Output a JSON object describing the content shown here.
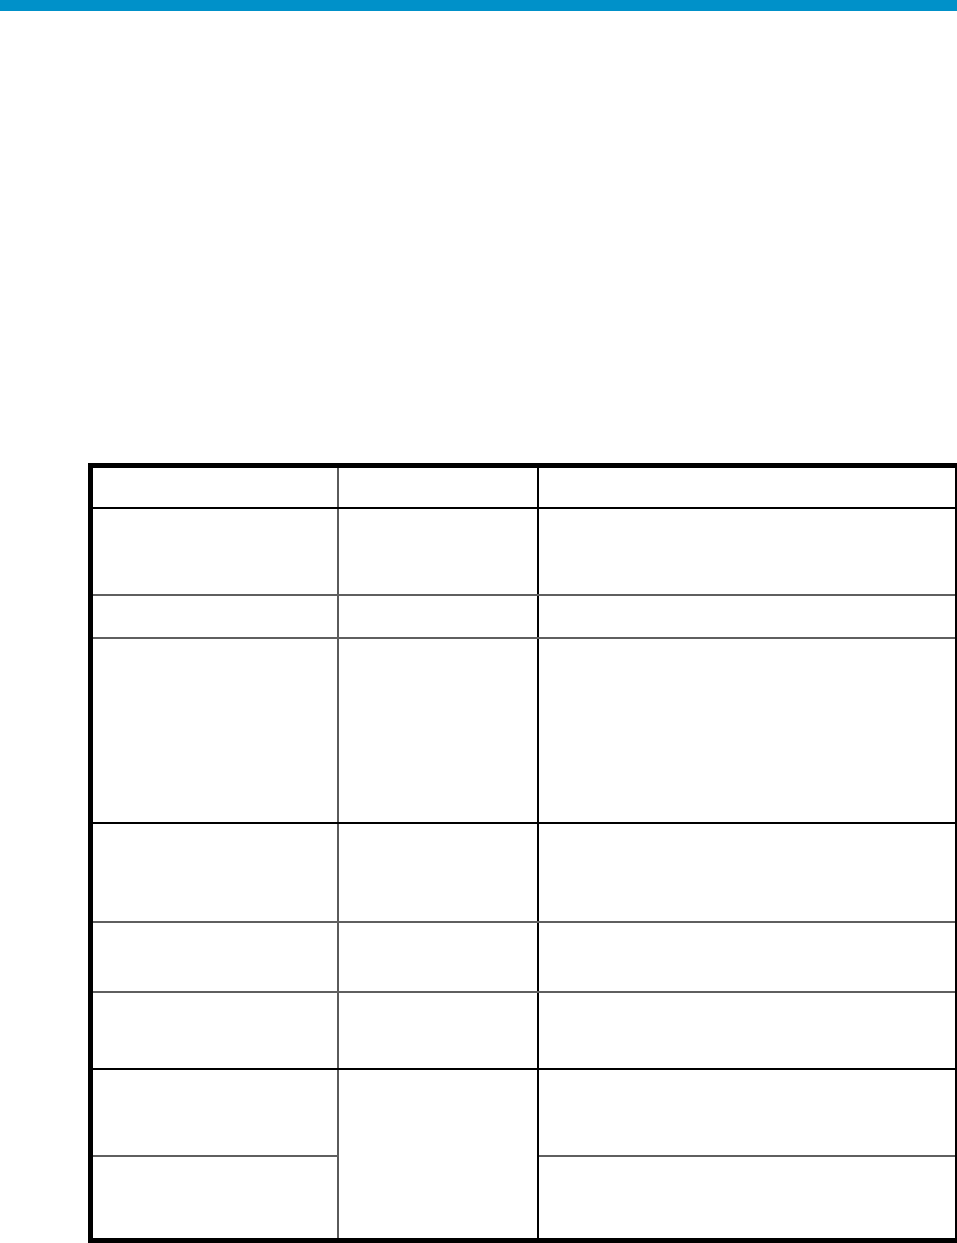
{
  "page": {
    "background_color": "#ffffff",
    "top_bar": {
      "color": "#0091c9",
      "height_px": 11
    }
  },
  "table": {
    "outer_border_color": "#000000",
    "grid_line_color": "#5a5a5a",
    "section_line_color": "#000000",
    "column_count": 3,
    "row_count": 9,
    "merged_cell": "middle column spans the last two rows",
    "rows": [
      {
        "role": "header",
        "cells": [
          "",
          "",
          ""
        ]
      },
      {
        "role": "body",
        "cells": [
          "",
          "",
          ""
        ]
      },
      {
        "role": "body",
        "cells": [
          "",
          "",
          ""
        ]
      },
      {
        "role": "body",
        "cells": [
          "",
          "",
          ""
        ]
      },
      {
        "role": "body",
        "cells": [
          "",
          "",
          ""
        ]
      },
      {
        "role": "body",
        "cells": [
          "",
          "",
          ""
        ]
      },
      {
        "role": "body",
        "cells": [
          "",
          "",
          ""
        ]
      },
      {
        "role": "body",
        "cells": [
          "",
          "",
          ""
        ]
      },
      {
        "role": "body",
        "cells": [
          "",
          ""
        ]
      }
    ]
  }
}
